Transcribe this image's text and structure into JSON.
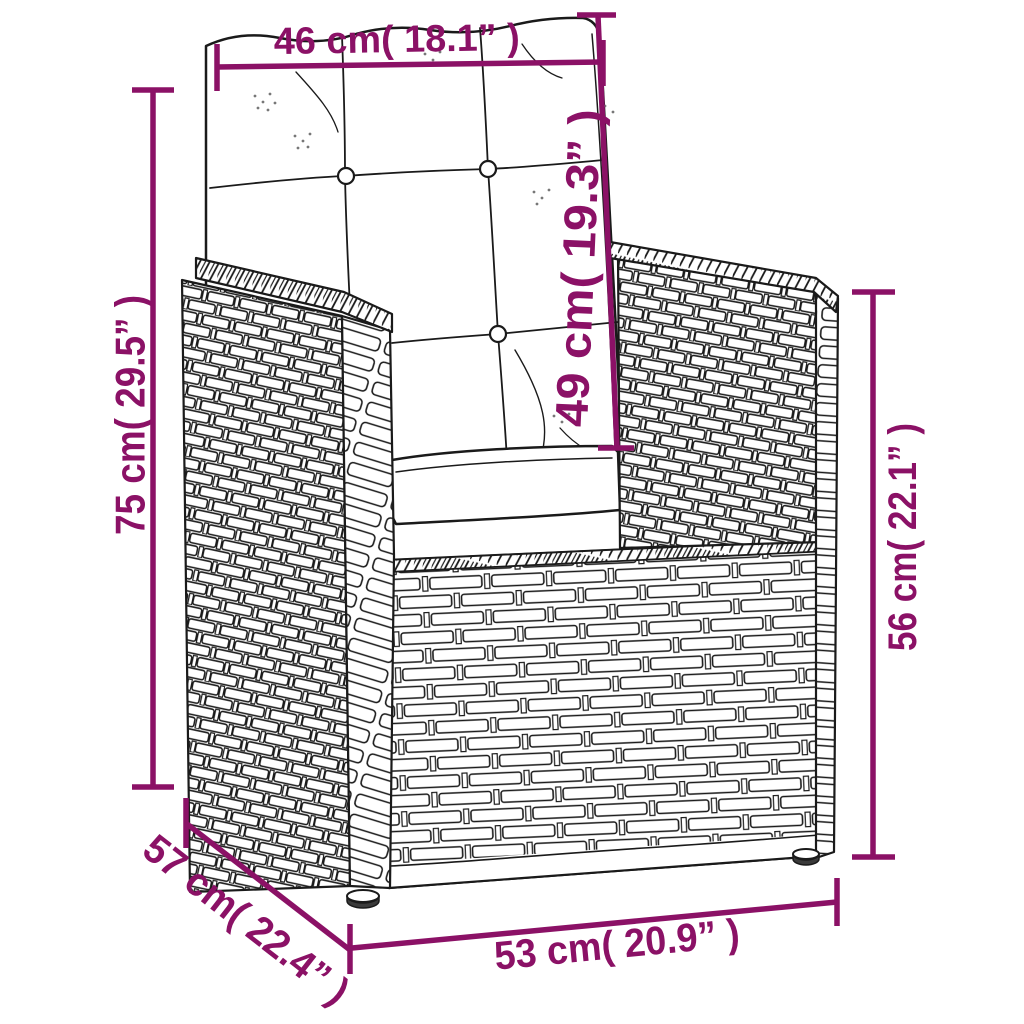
{
  "diagram": {
    "title": "Armchair dimension diagram",
    "product": "Poly rattan garden armchair with tufted cushions",
    "view": "three-quarter front line drawing",
    "style": {
      "accent_color": "#8b1166",
      "line_color": "#1a1a1a",
      "background": "#ffffff"
    },
    "dimensions": [
      {
        "id": "back-cushion-width",
        "cm": 46,
        "inch": 18.1,
        "orientation": "horizontal-top",
        "label": "46 cm( 18.1” )"
      },
      {
        "id": "back-cushion-height",
        "cm": 49,
        "inch": 19.3,
        "orientation": "vertical-back",
        "label": "49 cm( 19.3” )"
      },
      {
        "id": "total-height",
        "cm": 75,
        "inch": 29.5,
        "orientation": "vertical-left",
        "label": "75 cm( 29.5” )"
      },
      {
        "id": "armrest-height",
        "cm": 56,
        "inch": 22.1,
        "orientation": "vertical-right",
        "label": "56 cm( 22.1” )"
      },
      {
        "id": "seat-depth",
        "cm": 57,
        "inch": 22.4,
        "orientation": "diagonal-left",
        "label": "57 cm( 22.4” )"
      },
      {
        "id": "seat-width",
        "cm": 53,
        "inch": 20.9,
        "orientation": "horizontal-bottom",
        "label": "53 cm( 20.9” )"
      }
    ]
  }
}
